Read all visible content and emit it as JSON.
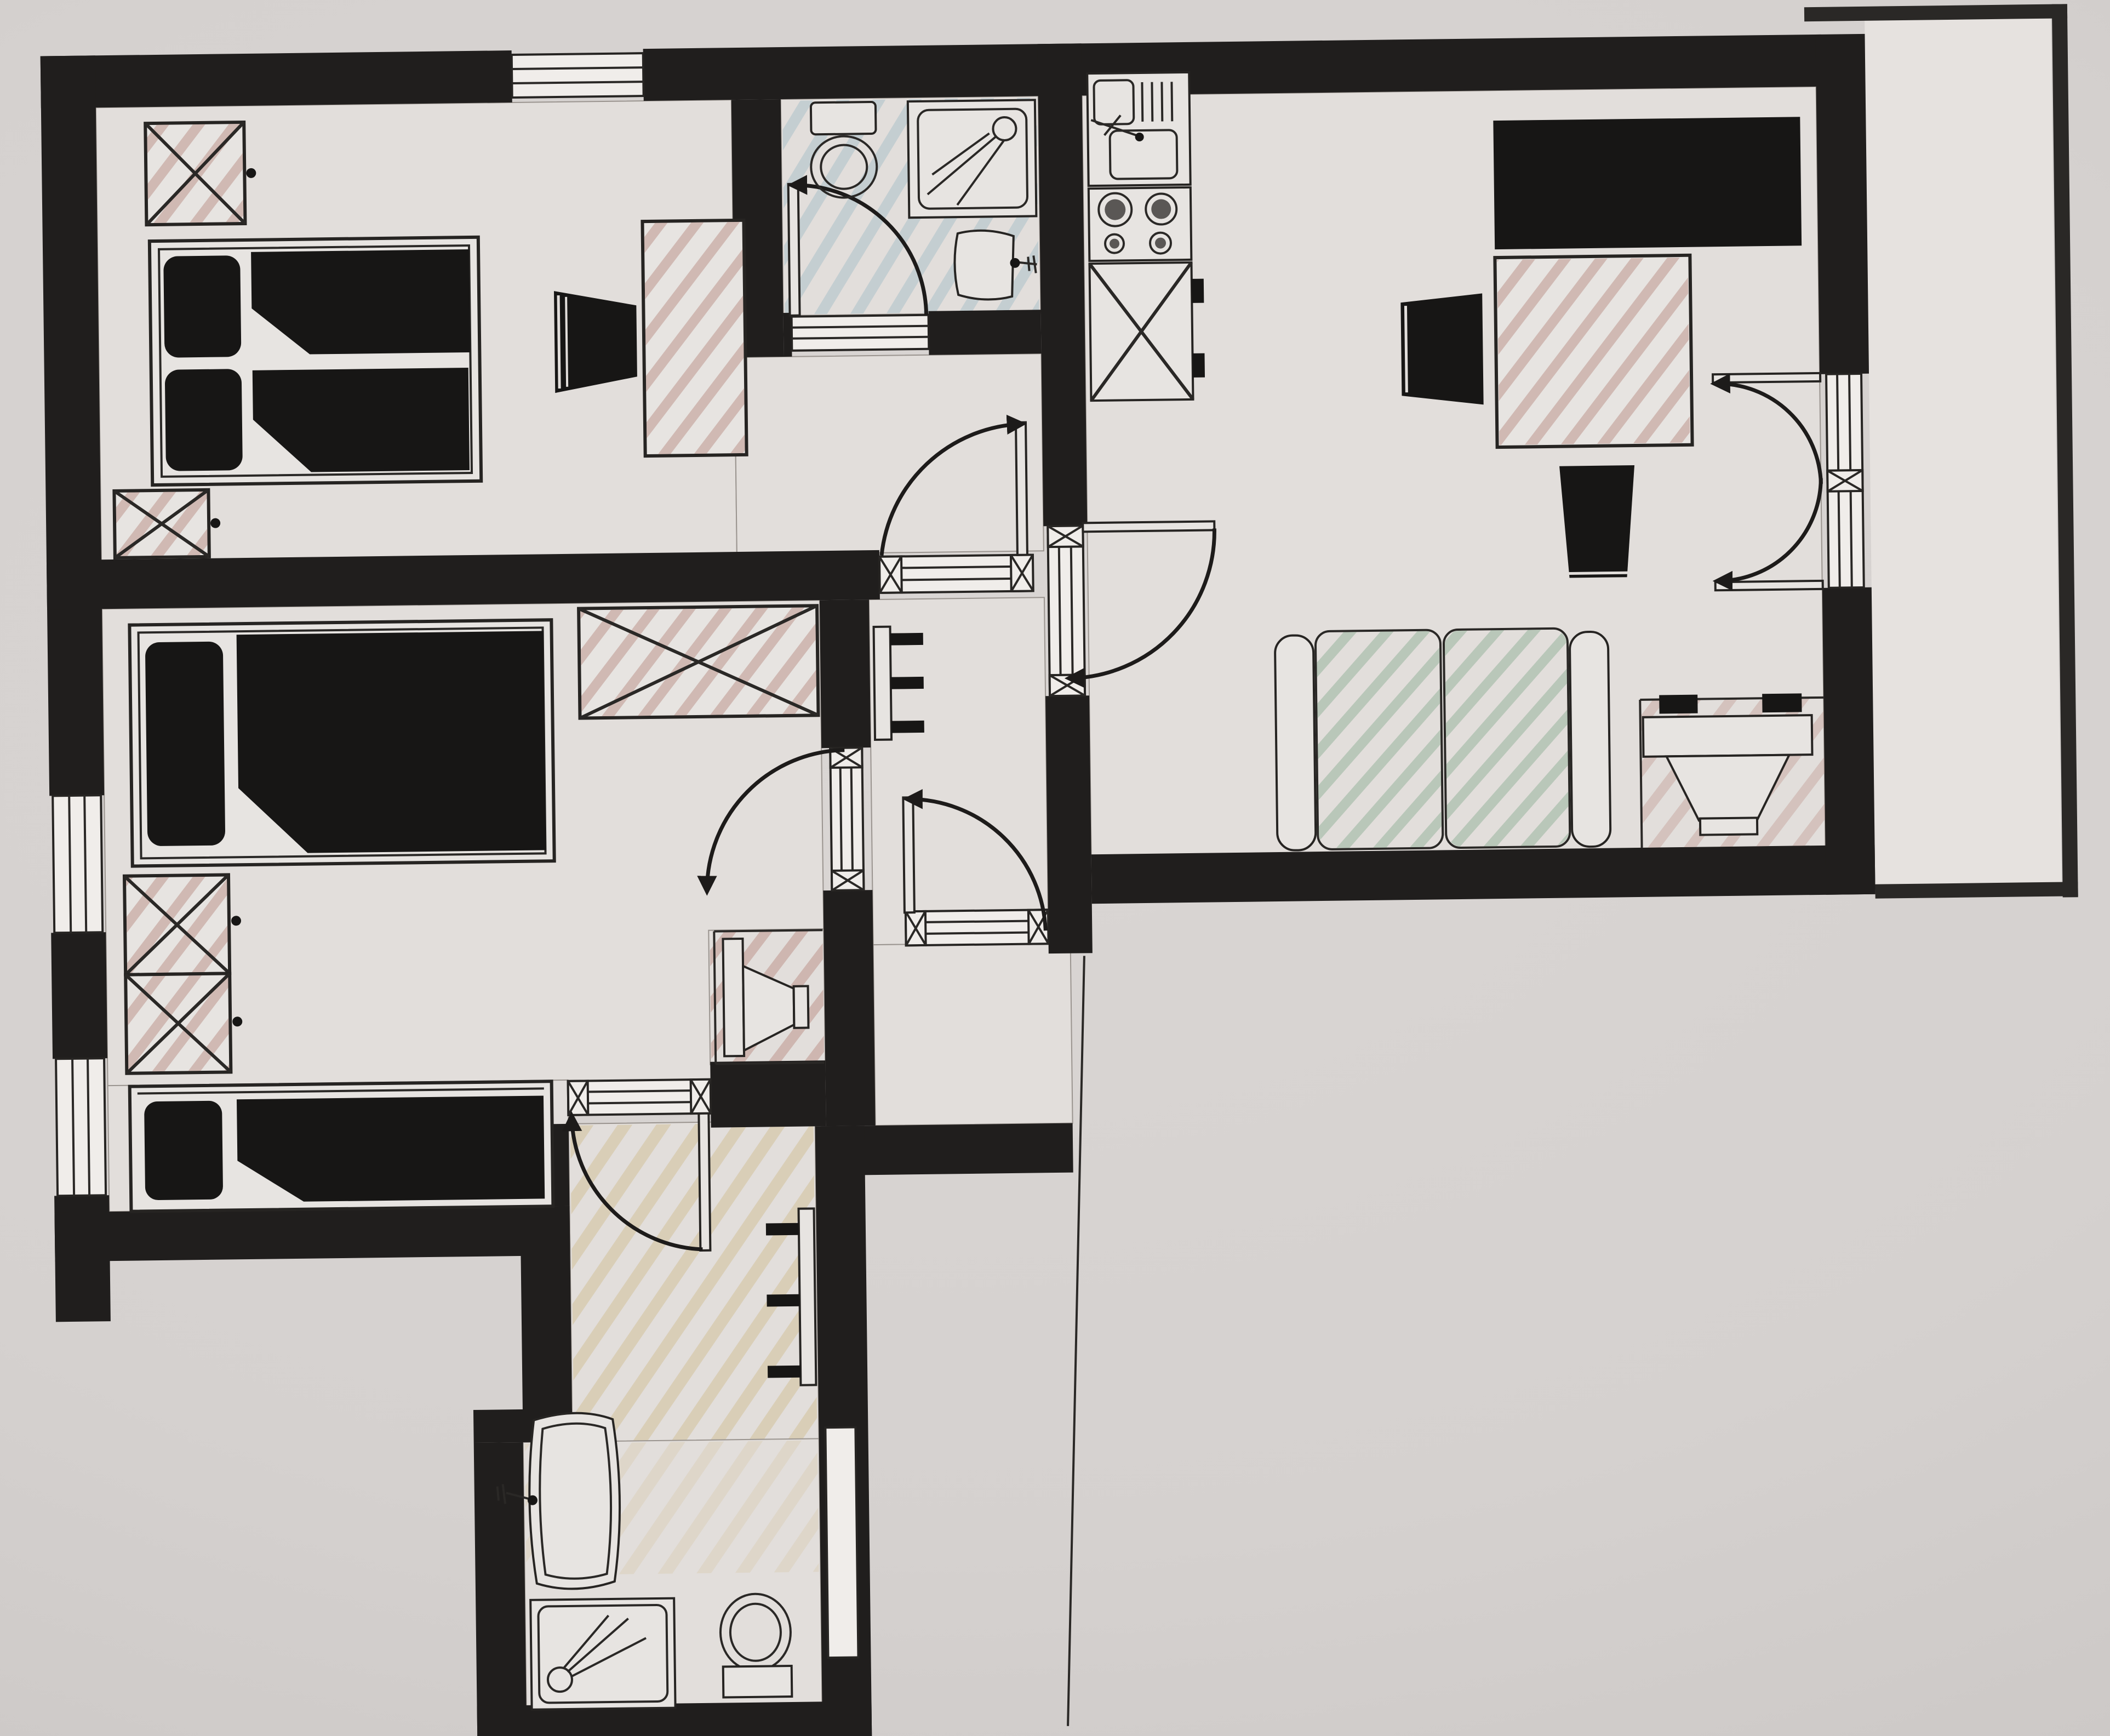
{
  "artifact": {
    "kind": "hand-colored architectural floor plan (photograph of paper drawing)",
    "visible_text": "none",
    "orientation": "plan slightly rotated, photographed on grey paper"
  },
  "palette": {
    "paper": "#d5d1cf",
    "floor": "#e2dedb",
    "wall_black": "#201e1d",
    "pencil_pink": "#b98d85",
    "pencil_blue": "#9fb9c4",
    "pencil_green": "#96b49c",
    "pencil_yellow": "#cdb98b",
    "ink_outline": "#2a2826"
  },
  "rooms": [
    {
      "id": "bedroom-top-left",
      "floor_shade": "plain",
      "furniture": [
        "double-bed",
        "pillow x2",
        "duvet x2",
        "nightstand-x-box x2 (pink)",
        "desk (pink) with chair"
      ],
      "openings": [
        "window-top-wall",
        "door-to-hall (south-east)"
      ]
    },
    {
      "id": "ensuite-bathroom-top",
      "floor_shade": "blue pencil hatch",
      "furniture": [
        "toilet",
        "shower-tray with drain and spray lines",
        "wash-basin with faucet"
      ],
      "openings": [
        "door-to-bedroom (south, swing inward)"
      ]
    },
    {
      "id": "living-room-right",
      "floor_shade": "plain",
      "furniture": [
        "kitchen-sink-unit",
        "stove-4-burners",
        "counter-x-box with handles",
        "black-bed-slab",
        "desk (pink)",
        "chair-trapezoid x2",
        "sofa-two-seat (green)",
        "desk-with-chair (south-east, pink)"
      ],
      "openings": [
        "door-from-hall (west)",
        "french-double-door-to-balcony (east)"
      ]
    },
    {
      "id": "balcony-right-strip",
      "floor_shade": "plain",
      "furniture": [],
      "openings": [
        "french-double-door"
      ]
    },
    {
      "id": "bedroom-middle-left",
      "floor_shade": "plain",
      "furniture": [
        "single-bed x2",
        "wardrobe-x-long (pink)",
        "wardrobe-x-box x2 (pink)",
        "tv-speaker-cabinet (south-east corner, pink)"
      ],
      "openings": [
        "window-left-wall x2",
        "door-to-hall (east)",
        "door-to-corridor (south)"
      ]
    },
    {
      "id": "hall-center",
      "floor_shade": "plain",
      "furniture": [
        "radiator-3-fins (west wall)"
      ],
      "openings": [
        "door-to-bedroom-top (north sill)",
        "door-to-living-room (east)",
        "entrance-door (south)",
        "door-to-bedroom-middle (west)"
      ]
    },
    {
      "id": "entrance-vestibule",
      "floor_shade": "plain",
      "furniture": [],
      "openings": [
        "entrance-door-sill"
      ]
    },
    {
      "id": "corridor-bottom",
      "floor_shade": "yellow pencil hatch",
      "furniture": [
        "radiator-3-fins (east wall)"
      ],
      "openings": [
        "door-from-bedroom-middle (north, swing into corridor)"
      ]
    },
    {
      "id": "bathroom-bottom",
      "floor_shade": "plain",
      "furniture": [
        "wash-basin with faucet",
        "shower-tray with drain and spray lines",
        "toilet with tank"
      ],
      "openings": []
    }
  ],
  "door_count": 7,
  "window_count": 3,
  "symbols": {
    "wall": "solid black band",
    "window": "white sill with parallel lines",
    "door": "quarter-circle swing arc with arrowhead and open leaf",
    "x_box": "rectangle with diagonal cross = wardrobe / cabinet",
    "radiator": "slim rectangle with three fins",
    "fold_line": "thin vertical paper line below living room"
  }
}
